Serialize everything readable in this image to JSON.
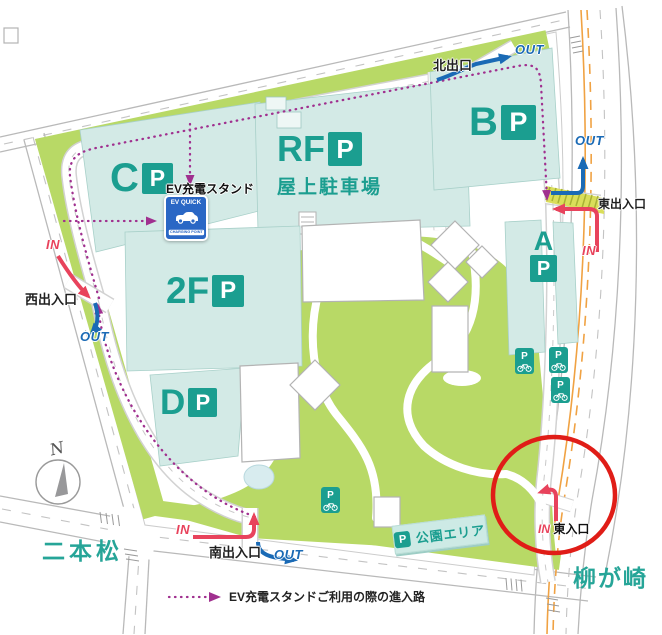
{
  "colors": {
    "teal": "#1b9e90",
    "teal-text": "#26a598",
    "bld": "#d3eae6",
    "stripe": "#c2e2dc",
    "green": "#b8d966",
    "blue": "#1a6ab5",
    "red": "#e8435c",
    "purple": "#a0308f",
    "circle": "#e01d17",
    "orange": "#f0a243",
    "ink": "#1f1f1f"
  },
  "compass": {
    "n": "N"
  },
  "districts": {
    "nihonmatsu": "二本松",
    "yanagasaki": "柳が崎"
  },
  "gates": {
    "north": {
      "label": "北出口",
      "out": "OUT"
    },
    "east": {
      "label": "東出入口",
      "in": "IN",
      "out": "OUT"
    },
    "west": {
      "label": "西出入口",
      "in": "IN",
      "out": "OUT"
    },
    "south": {
      "label": "南出入口",
      "in": "IN",
      "out": "OUT"
    },
    "east_entrance": {
      "label": "東入口",
      "in": "IN"
    }
  },
  "parking": {
    "c": {
      "name": "C",
      "p": "P"
    },
    "rf": {
      "name": "RF",
      "p": "P",
      "subtitle": "屋上駐車場"
    },
    "b": {
      "name": "B",
      "p": "P"
    },
    "a": {
      "name": "A",
      "p": "P"
    },
    "f2": {
      "name": "2F",
      "p": "P"
    },
    "d": {
      "name": "D",
      "p": "P"
    }
  },
  "ev": {
    "label": "EV充電スタンド",
    "sign_title": "EV QUICK",
    "sign_sub": "CHARGING POINT"
  },
  "bicycle": {
    "p": "P"
  },
  "park_sign": {
    "p": "P",
    "label": "公園エリア"
  },
  "legend": {
    "text": "EV充電スタンドご利用の際の進入路"
  }
}
